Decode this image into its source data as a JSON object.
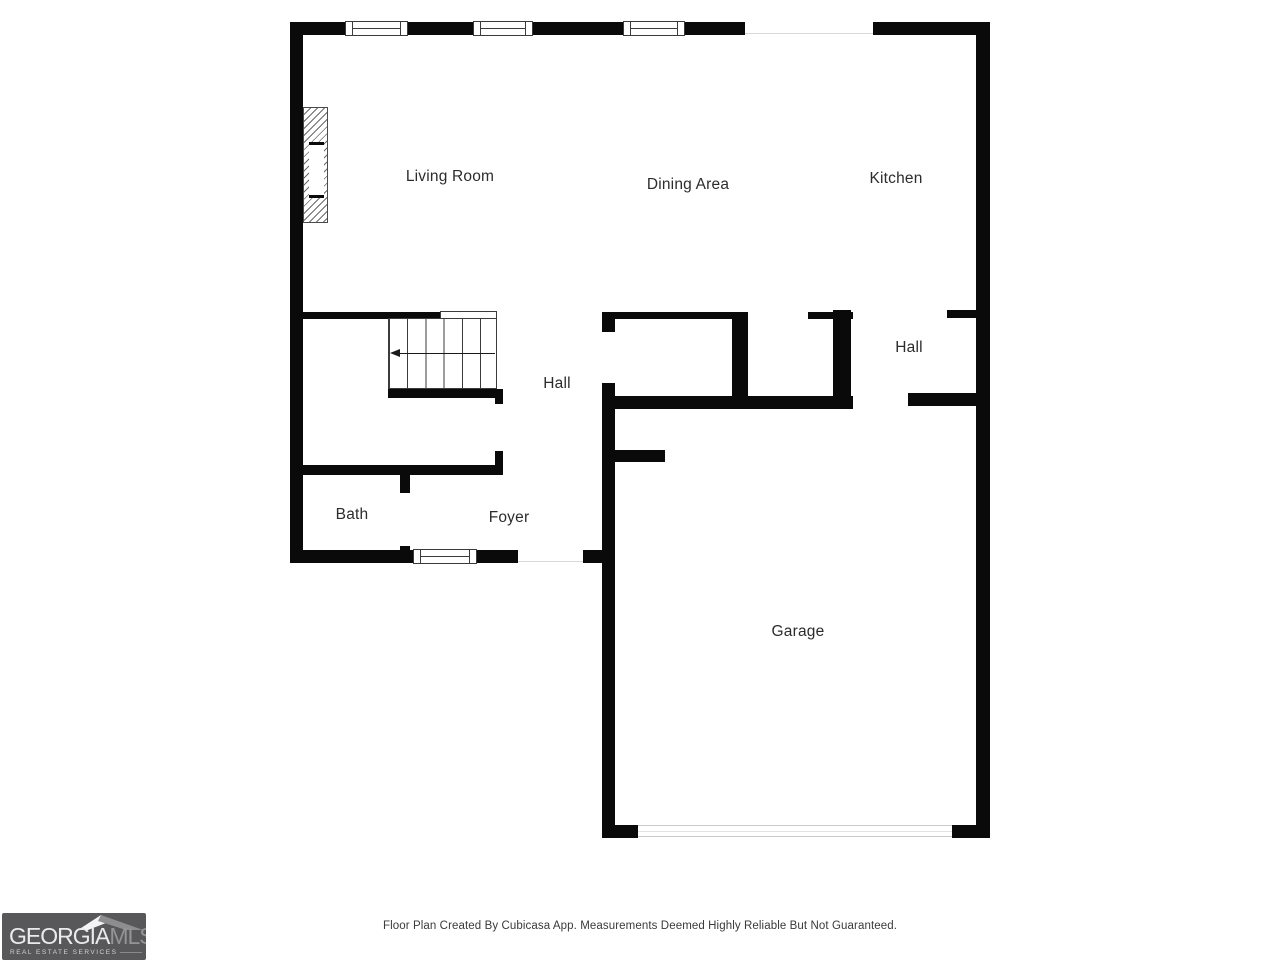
{
  "plan": {
    "rooms": [
      {
        "id": "living-room",
        "label": "Living Room"
      },
      {
        "id": "dining-area",
        "label": "Dining Area"
      },
      {
        "id": "kitchen",
        "label": "Kitchen"
      },
      {
        "id": "hall-upper",
        "label": "Hall"
      },
      {
        "id": "hall-lower",
        "label": "Hall"
      },
      {
        "id": "bath",
        "label": "Bath"
      },
      {
        "id": "foyer",
        "label": "Foyer"
      },
      {
        "id": "garage",
        "label": "Garage"
      }
    ],
    "symbols": [
      "staircase-with-down-arrow",
      "fireplace",
      "windows",
      "garage-door",
      "door-openings"
    ]
  },
  "footer": {
    "disclaimer": "Floor Plan Created By Cubicasa App. Measurements Deemed Highly Reliable But Not Guaranteed."
  },
  "logo": {
    "name": "Georgia MLS",
    "primary": "GEORGIA",
    "secondary": "MLS",
    "tagline": "REAL ESTATE SERVICES",
    "bg_color": "#58585a"
  },
  "colors": {
    "wall": "#0a0a0a",
    "background": "#ffffff",
    "opening_line": "#d9d9d9",
    "label_text": "#2c2c2c"
  }
}
